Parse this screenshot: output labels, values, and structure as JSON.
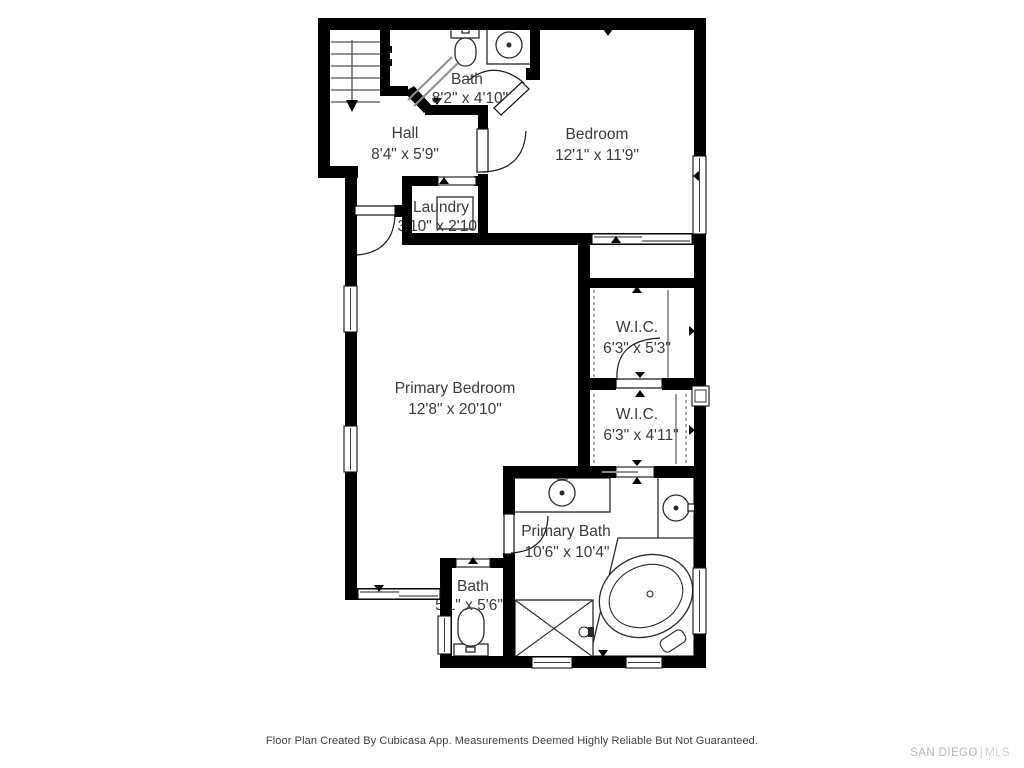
{
  "plan": {
    "rooms": {
      "bath_upper": {
        "name": "Bath",
        "dims": "8'2\" x 4'10\""
      },
      "hall": {
        "name": "Hall",
        "dims": "8'4\" x 5'9\""
      },
      "bedroom": {
        "name": "Bedroom",
        "dims": "12'1\" x 11'9\""
      },
      "laundry": {
        "name": "Laundry",
        "dims": "3'10\" x 2'10\""
      },
      "primary_bedroom": {
        "name": "Primary Bedroom",
        "dims": "12'8\" x 20'10\""
      },
      "wic_upper": {
        "name": "W.I.C.",
        "dims": "6'3\" x 5'3\""
      },
      "wic_lower": {
        "name": "W.I.C.",
        "dims": "6'3\" x 4'11\""
      },
      "primary_bath": {
        "name": "Primary Bath",
        "dims": "10'6\" x 10'4\""
      },
      "bath_lower": {
        "name": "Bath",
        "dims": "5'1\" x 5'6\""
      }
    },
    "colors": {
      "wall": "#000000",
      "fixture_line": "#2a2a2a",
      "label_text": "#3a3a3a",
      "watermark": "#c0c3c5"
    }
  },
  "footer": {
    "disclaimer": "Floor Plan Created By Cubicasa App. Measurements Deemed Highly Reliable But Not Guaranteed."
  },
  "watermark": {
    "primary": "SAN DIEGO",
    "separator": "|",
    "secondary": "MLS"
  }
}
